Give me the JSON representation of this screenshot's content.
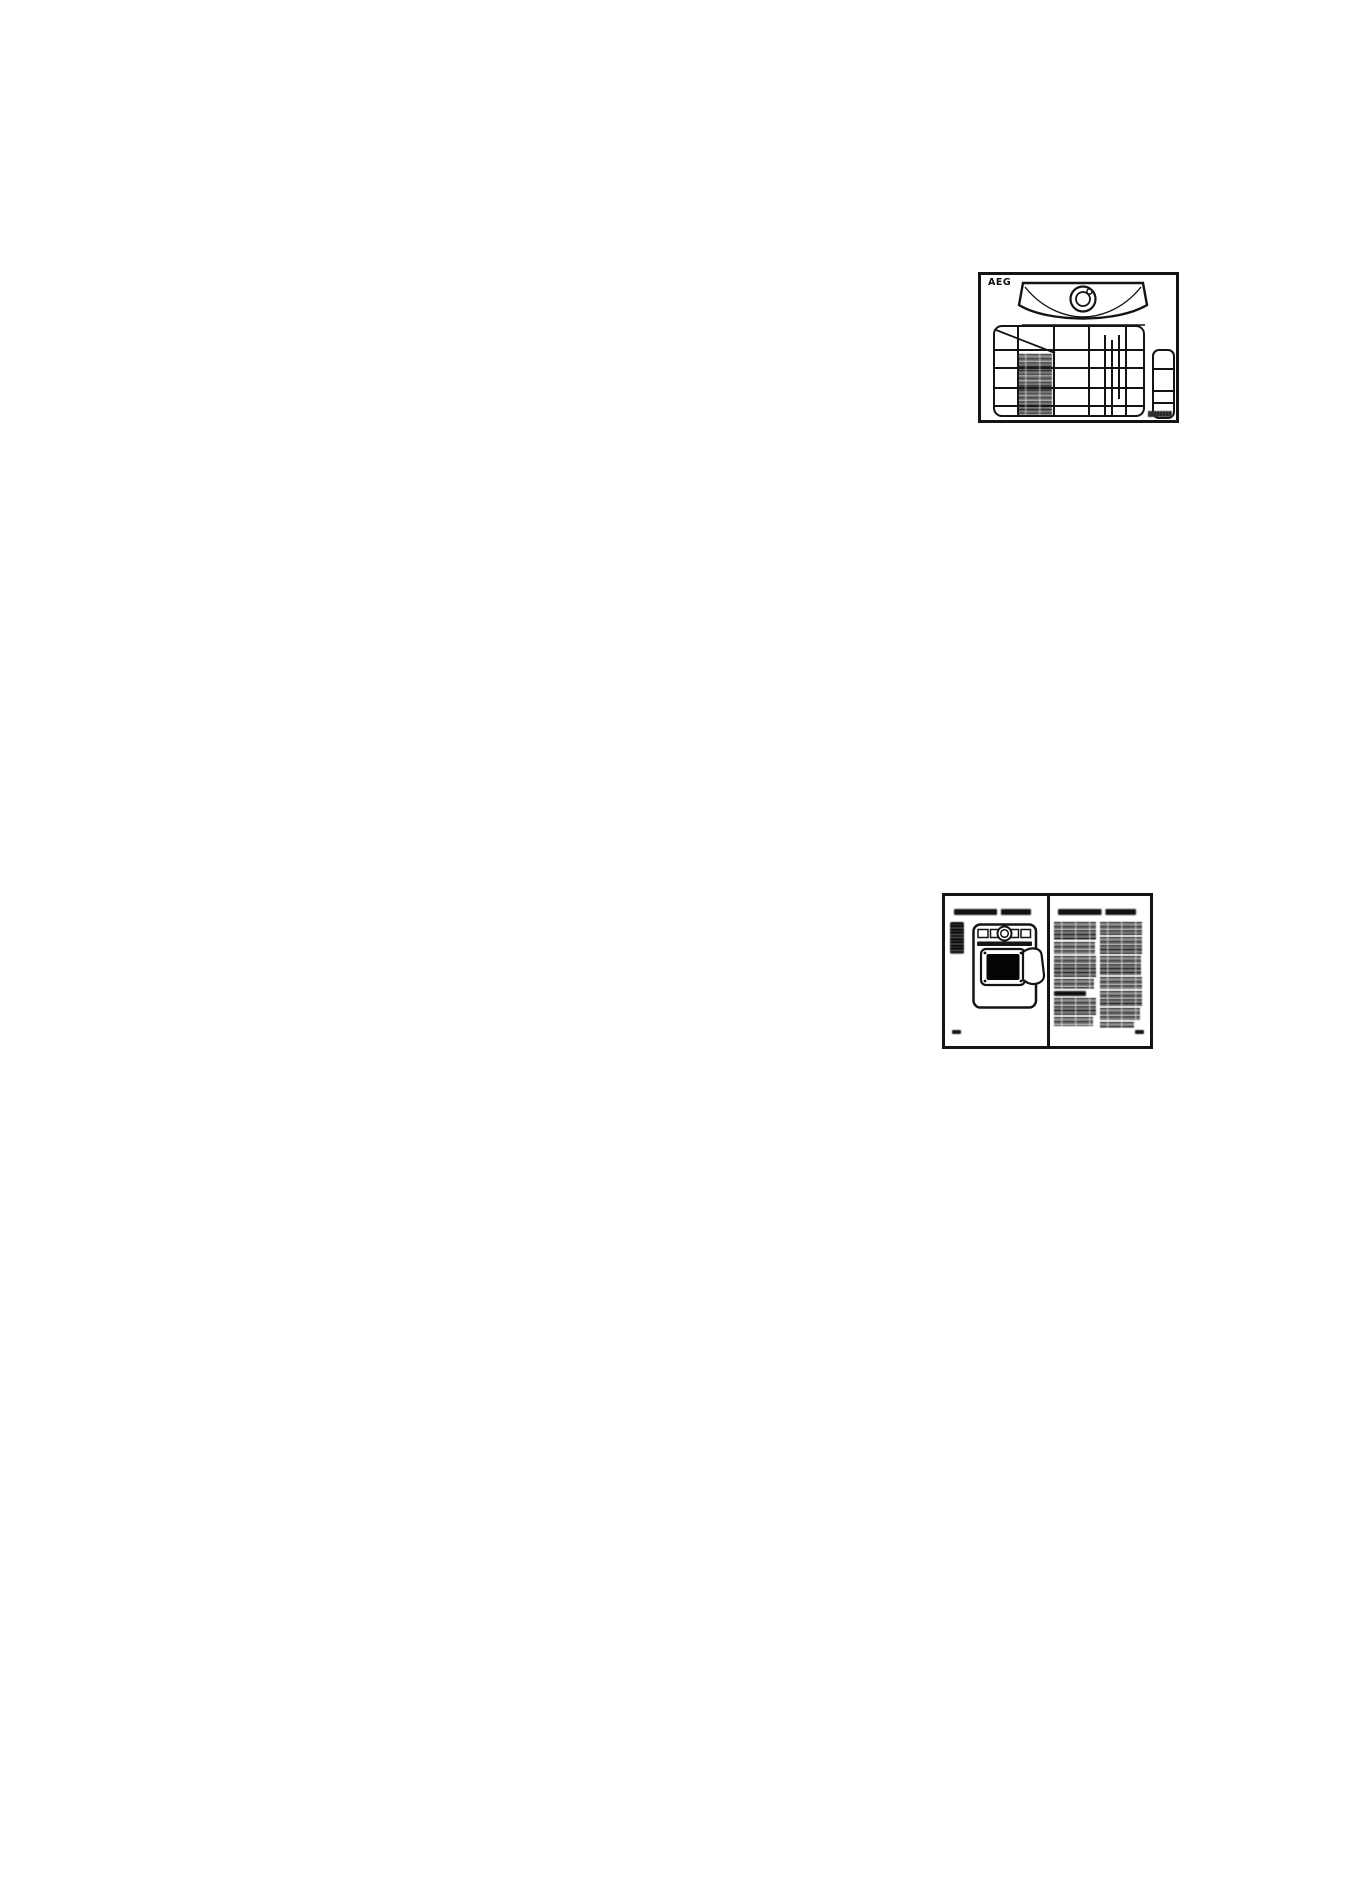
{
  "document": {
    "background_color": "#ffffff",
    "ink_color": "#141414"
  },
  "figure_appliance": {
    "brand_label": "AEG"
  }
}
